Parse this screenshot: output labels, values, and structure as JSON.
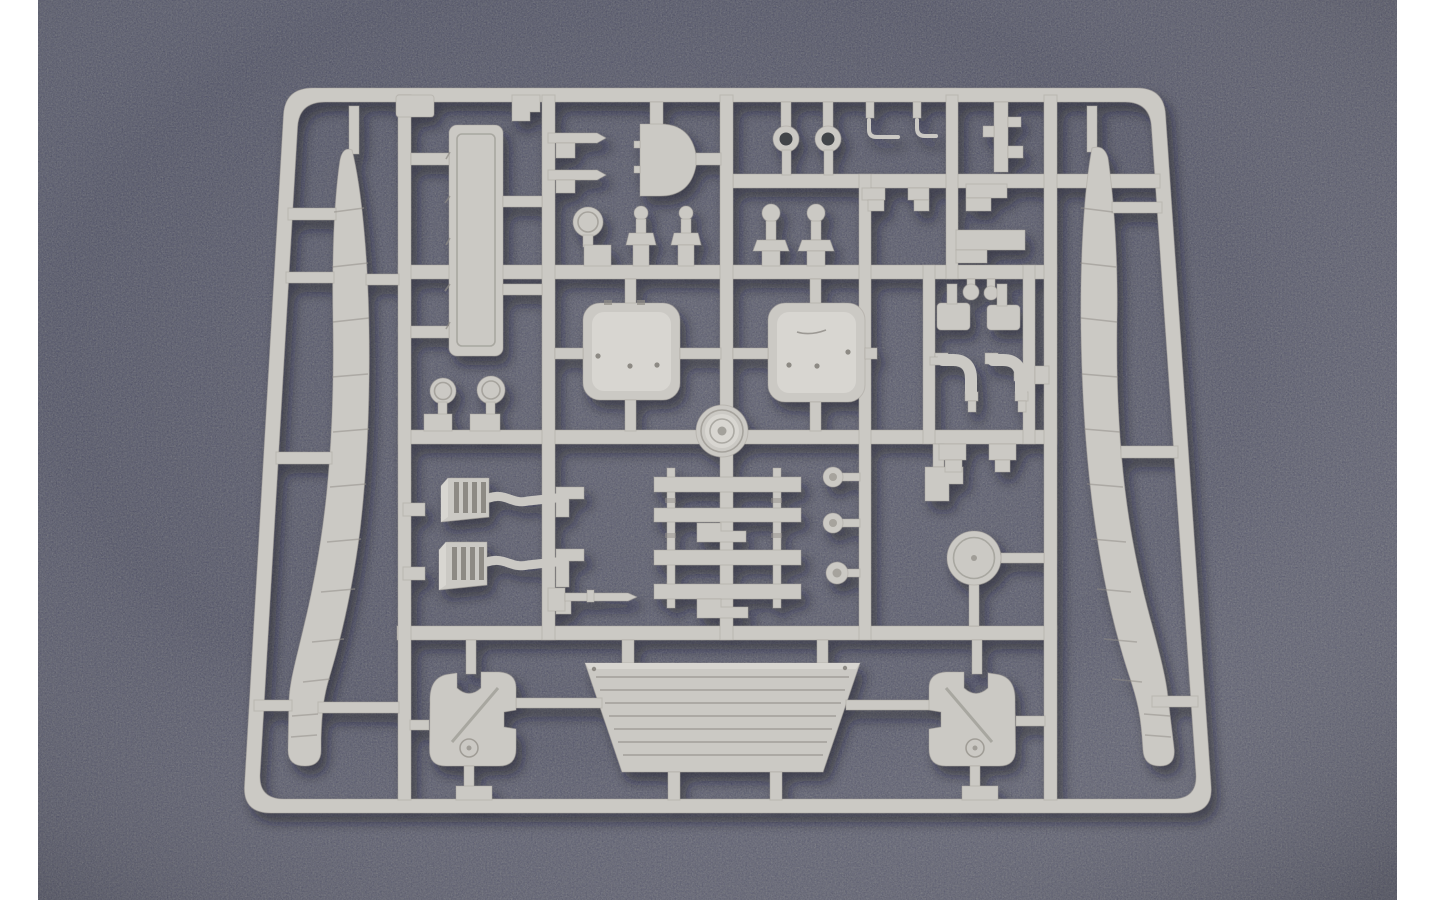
{
  "scene": {
    "type": "photograph",
    "subject": "injection-molded plastic model-kit sprue of tank parts lying on a dark speckled surface",
    "colors": {
      "margin": "#ffffff",
      "background_top": "#53565b",
      "background_mid": "#57595d",
      "background_bottom": "#67696c",
      "plastic": "#cbc9c4",
      "plastic_light": "#d8d6d1",
      "plastic_edge": "#a3a09a",
      "plastic_detail": "#8d8a84",
      "slot_dark": "#43454a",
      "shadow": "#14161a"
    },
    "parts": [
      {
        "name": "sprue-frame",
        "count": 1
      },
      {
        "name": "runner-bar",
        "count": 12
      },
      {
        "name": "side-skirt-strip",
        "count": 2
      },
      {
        "name": "louvered-plank",
        "count": 1
      },
      {
        "name": "travel-lock-bar",
        "count": 2
      },
      {
        "name": "half-round-cover",
        "count": 1
      },
      {
        "name": "round-mirror",
        "count": 1
      },
      {
        "name": "periscope-post",
        "count": 2
      },
      {
        "name": "tow-eyelet",
        "count": 2
      },
      {
        "name": "wire-hook",
        "count": 2
      },
      {
        "name": "corner-post",
        "count": 1
      },
      {
        "name": "round-head-post",
        "count": 2
      },
      {
        "name": "step-foot",
        "count": 4
      },
      {
        "name": "hatch-panel",
        "count": 2
      },
      {
        "name": "hub-ring",
        "count": 1
      },
      {
        "name": "stemmed-disc",
        "count": 2
      },
      {
        "name": "intake-grille",
        "count": 2
      },
      {
        "name": "elbow-fitting",
        "count": 2
      },
      {
        "name": "gun-rod",
        "count": 1
      },
      {
        "name": "step-frame-ladder",
        "count": 1
      },
      {
        "name": "knob",
        "count": 3
      },
      {
        "name": "notched-block",
        "count": 2
      },
      {
        "name": "round-cap-wheel",
        "count": 1
      },
      {
        "name": "pipe-elbow",
        "count": 2
      },
      {
        "name": "hanger-block",
        "count": 6
      },
      {
        "name": "engine-deck-plate",
        "count": 1
      },
      {
        "name": "mount-bracket",
        "count": 2
      }
    ]
  }
}
